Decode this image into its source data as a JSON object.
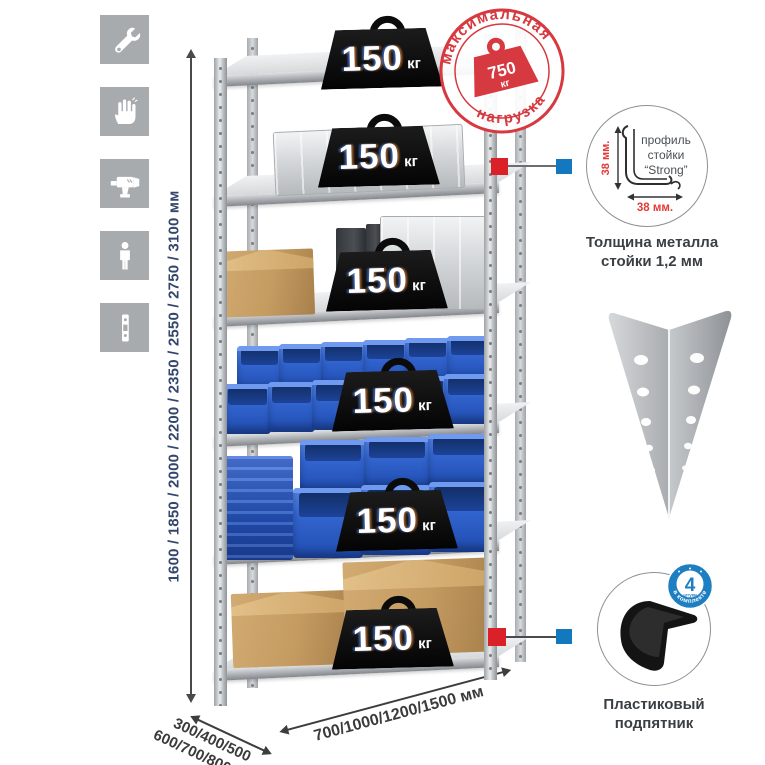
{
  "colors": {
    "stamp_red": "#d6393f",
    "connector_red": "#da2128",
    "connector_blue": "#1478be",
    "badge_blue": "#1d7fc2",
    "bin_blue": "#2d5ec7",
    "icon_gray": "#a7abae",
    "height_text": "#33466b"
  },
  "icons": [
    {
      "name": "wrench-icon"
    },
    {
      "name": "gloves-icon"
    },
    {
      "name": "drill-icon"
    },
    {
      "name": "person-icon"
    },
    {
      "name": "perforated-strip-icon"
    }
  ],
  "dimensions": {
    "height_label": "1600 / 1850 / 2000 / 2200 / 2350 / 2550 / 2750 / 3100 мм",
    "depth_line1": "300/400/500",
    "depth_line2": "600/700/800 мм",
    "width_label": "700/1000/1200/1500 мм"
  },
  "stamp": {
    "arc_top": "максимальная",
    "arc_bottom": "нагрузка",
    "value": "750",
    "unit": "кг"
  },
  "shelves": [
    {
      "load_value": "150",
      "load_unit": "кг",
      "contents": "empty-top-shelf"
    },
    {
      "load_value": "150",
      "load_unit": "кг",
      "contents": "aluminum-case"
    },
    {
      "load_value": "150",
      "load_unit": "кг",
      "contents": "cardboard-box-and-aluminum-boxes"
    },
    {
      "load_value": "150",
      "load_unit": "кг",
      "contents": "small-blue-plastic-bins"
    },
    {
      "load_value": "150",
      "load_unit": "кг",
      "contents": "large-blue-plastic-bins"
    },
    {
      "load_value": "150",
      "load_unit": "кг",
      "contents": "cardboard-boxes"
    }
  ],
  "profile_detail": {
    "line1": "профиль",
    "line2": "стойки",
    "line3": "“Strong”",
    "dim_v": "38 мм.",
    "dim_h": "38 мм.",
    "caption1": "Толщина металла",
    "caption2": "стойки 1,2 мм"
  },
  "foot_detail": {
    "badge_value": "4",
    "badge_small": "штуки",
    "badge_arc": "в комплекте",
    "caption1": "Пластиковый",
    "caption2": "подпятник"
  }
}
